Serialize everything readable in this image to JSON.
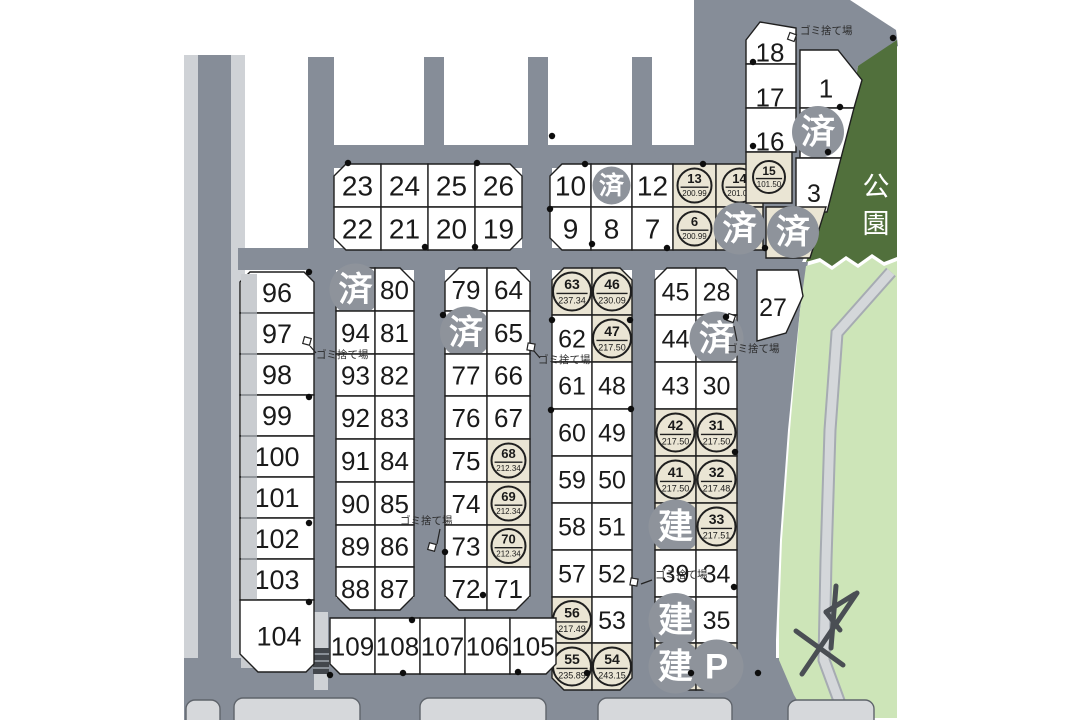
{
  "labels": {
    "park": "公園",
    "garbage": "ゴミ捨て場",
    "sold": "済",
    "built": "建",
    "parking": "P"
  },
  "colors": {
    "road": "#868D98",
    "sidewalk": "#CFD2D6",
    "lot_white": "#FFFFFF",
    "lot_reserved": "#EAE5D4",
    "status_circle": "#8E939B",
    "park_dark": "#51703C",
    "park_light": "#CDE5B8",
    "path_fill": "#D4D7DA",
    "path_edge": "#A6ABB2",
    "neighbor": "#D6D8DB",
    "outline": "#1F1F1F",
    "text": "#1A1A1A"
  },
  "blocks": {
    "north_a": [
      [
        "23",
        "24",
        "25",
        "26"
      ],
      [
        "22",
        "21",
        "20",
        "19"
      ]
    ],
    "north_b": [
      [
        "10",
        "S",
        "12",
        "13|200.99",
        "14|201.00"
      ],
      [
        "9",
        "8",
        "7",
        "6|200.99",
        "S*"
      ]
    ],
    "ne": {
      "stack": [
        "18",
        "17",
        "16"
      ],
      "lot15": "15|101.50",
      "lot1": "1",
      "lot2": "S",
      "lot3": "3",
      "lot4": "S*",
      "lot27": "27"
    },
    "col1": [
      "96",
      "97",
      "98",
      "99",
      "100",
      "101",
      "102",
      "103"
    ],
    "lot104": "104",
    "col2_left": [
      "S",
      "94",
      "93",
      "92",
      "91",
      "90",
      "89",
      "88"
    ],
    "col2_right": [
      "80",
      "81",
      "82",
      "83",
      "84",
      "85",
      "86",
      "87"
    ],
    "col3_left": [
      "79",
      "S",
      "77",
      "76",
      "75",
      "74",
      "73",
      "72"
    ],
    "col3_right": [
      "64",
      "65",
      "66",
      "67",
      "68|212.34",
      "69|212.34",
      "70|212.34",
      "71"
    ],
    "col4_left": [
      "63|237.34",
      "62",
      "61",
      "60",
      "59",
      "58",
      "57",
      "56|217.49",
      "55|235.89"
    ],
    "col4_right": [
      "46|230.09",
      "47|217.50",
      "48",
      "49",
      "50",
      "51",
      "52",
      "53",
      "54|243.15"
    ],
    "col5_left": [
      "45",
      "44",
      "43",
      "42|217.50",
      "41|217.50",
      "B*",
      "39",
      "B",
      "B*"
    ],
    "col5_right": [
      "28",
      "S",
      "30",
      "31|217.50",
      "32|217.48",
      "33|217.51",
      "34",
      "35",
      "P*"
    ],
    "south": [
      "109",
      "108",
      "107",
      "106",
      "105"
    ]
  }
}
